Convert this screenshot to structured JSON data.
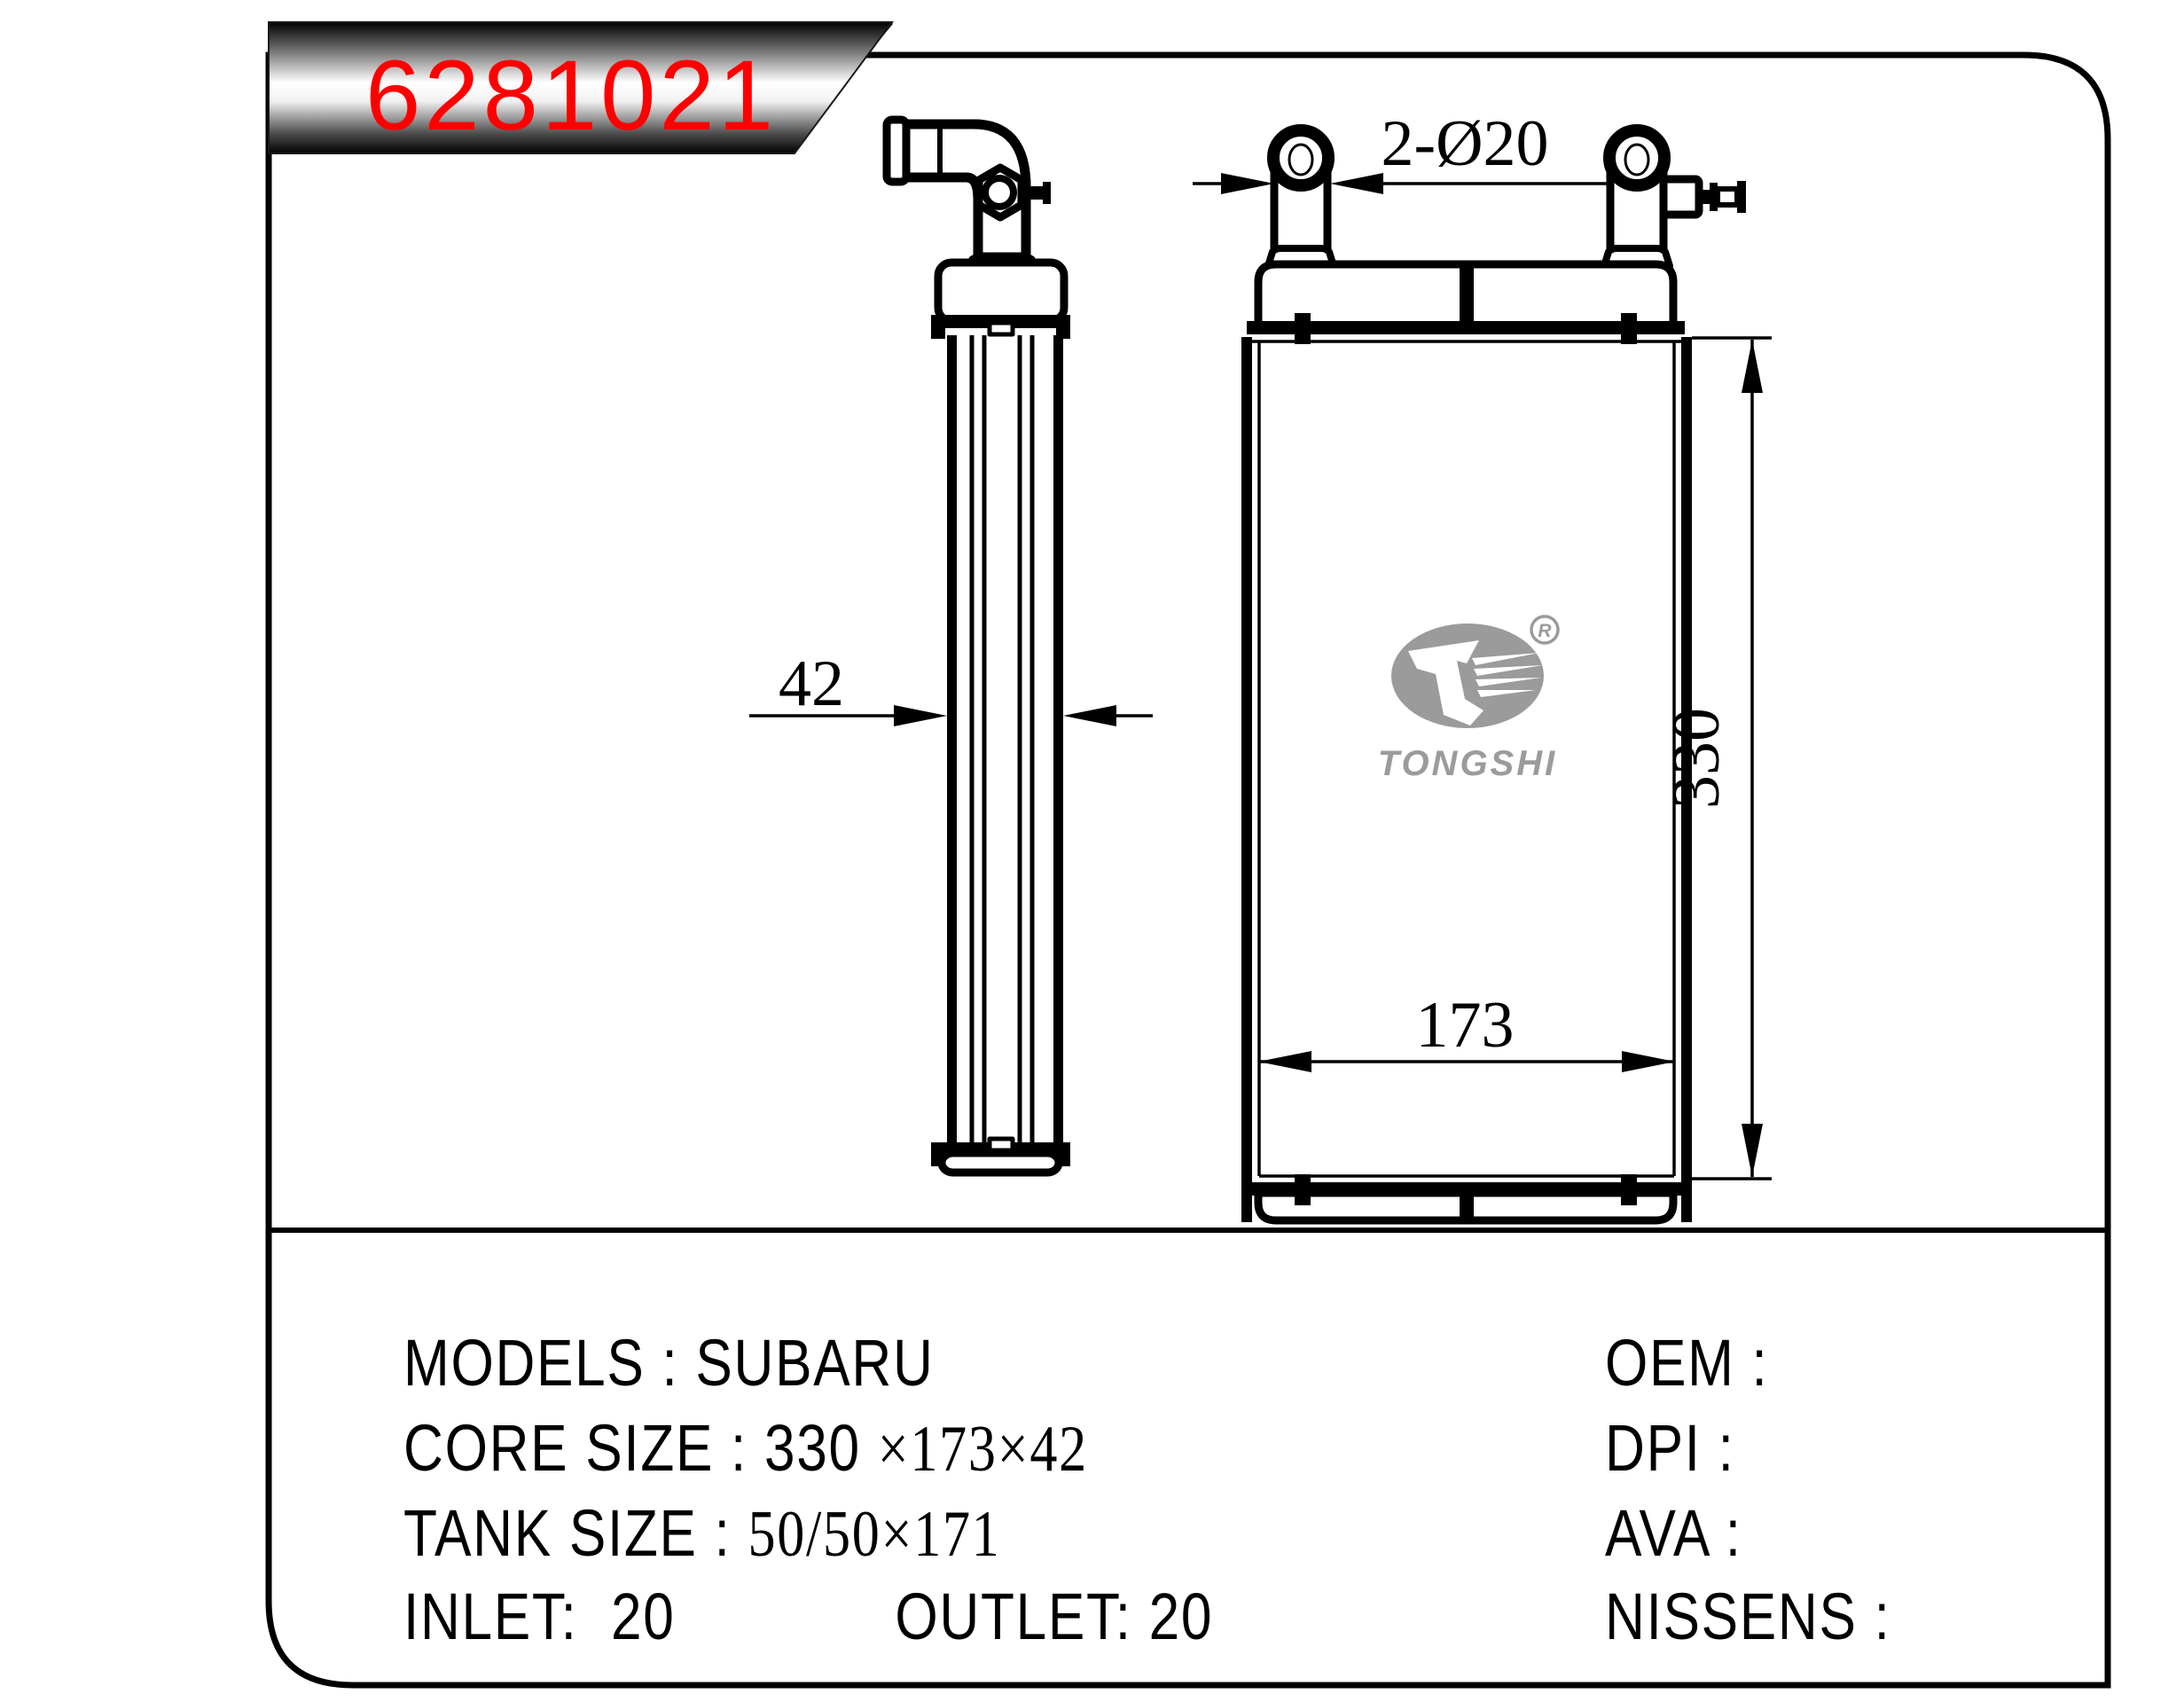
{
  "banner": {
    "part_number": "6281021"
  },
  "side_view": {
    "thickness_label": "42"
  },
  "front_view": {
    "ports_label": "2-Ø20",
    "height_label": "330",
    "width_label": "173",
    "logo_brand": "TONGSHI",
    "logo_registered": "R"
  },
  "specs": {
    "models_label": "MODELS :",
    "models_value": "SUBARU",
    "core_label": "CORE SIZE :",
    "core_value_sans": "330",
    "core_value_serif": "×173×42",
    "tank_label": "TANK SIZE :",
    "tank_value": "50/50×171",
    "inlet_label": "INLET:",
    "inlet_value": "20",
    "outlet_label": "OUTLET:",
    "outlet_value": "20",
    "right_rows": [
      "OEM :",
      "DPI :",
      "AVA :",
      "NISSENS :"
    ]
  },
  "colors": {
    "accent_red": "#fe0000",
    "logo_gray": "#9b9b9b",
    "line": "#000000"
  }
}
